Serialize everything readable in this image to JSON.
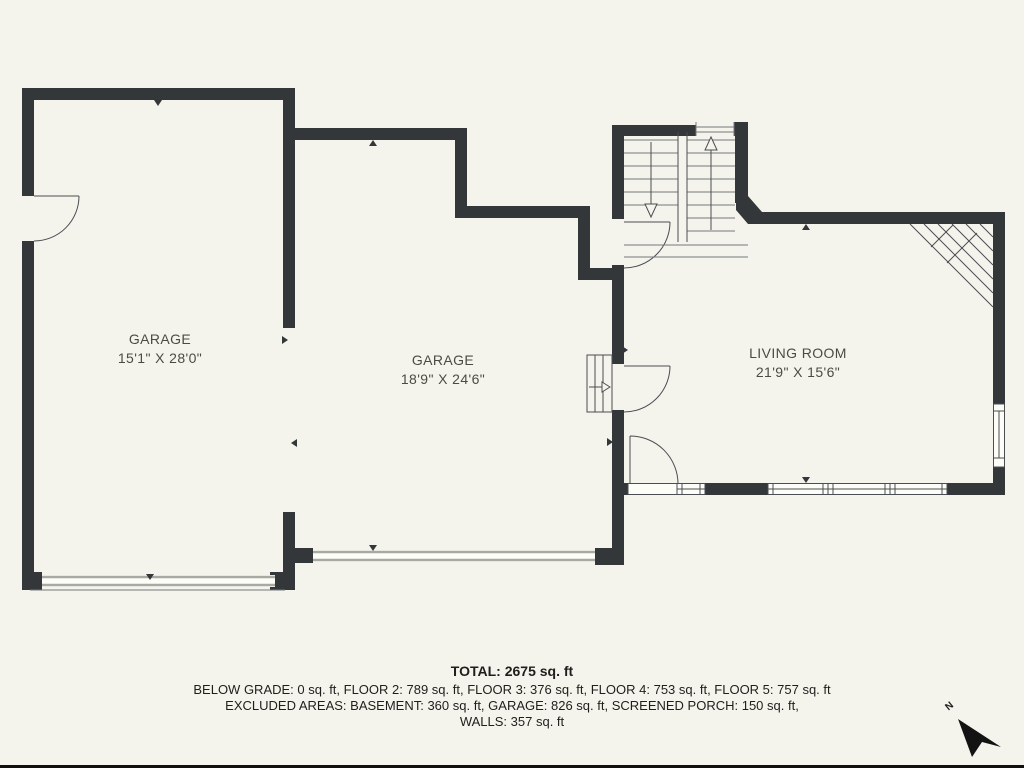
{
  "plan": {
    "rooms": [
      {
        "name": "GARAGE",
        "dimensions": "15'1\" X 28'0\""
      },
      {
        "name": "GARAGE",
        "dimensions": "18'9\" X 24'6\""
      },
      {
        "name": "LIVING ROOM",
        "dimensions": "21'9\" X 15'6\""
      }
    ],
    "north_label": "N"
  },
  "summary": {
    "total": "TOTAL: 2675 sq. ft",
    "floors": "BELOW GRADE: 0 sq. ft, FLOOR 2: 789 sq. ft, FLOOR 3: 376 sq. ft, FLOOR 4: 753 sq. ft, FLOOR 5: 757 sq. ft",
    "excluded": "EXCLUDED AREAS: BASEMENT: 360 sq. ft, GARAGE: 826 sq. ft, SCREENED PORCH: 150 sq. ft,",
    "walls": "WALLS: 357 sq. ft"
  },
  "colors": {
    "background": "#f5f4ec",
    "wall": "#33373a",
    "line": "#4a4e52",
    "garage_door": "#a9a9a4",
    "room_text": "#4b4b45",
    "summary_text": "#1e1e1c"
  }
}
